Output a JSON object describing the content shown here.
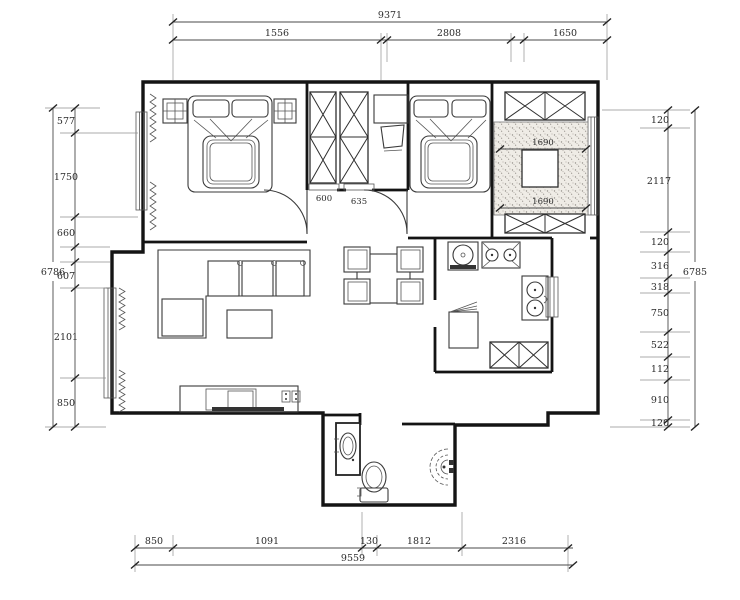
{
  "page": {
    "background": "#ffffff"
  },
  "palette": {
    "wall_line": "#141414",
    "dim_line": "#4a4a4a",
    "dim_text": "#2a2a2a",
    "hatch_bg": "#efece6",
    "hatch_dot": "#95908a"
  },
  "dimensions": {
    "top": {
      "overall": "9371",
      "segments": [
        "1556",
        "2808",
        "1650"
      ]
    },
    "bottom": {
      "overall": "9559",
      "segments": [
        "850",
        "1091",
        "130",
        "1812",
        "2316"
      ]
    },
    "left": {
      "overall": "6786",
      "segments": [
        "577",
        "1750",
        "660",
        "607",
        "2101",
        "850"
      ]
    },
    "right": {
      "overall": "6785",
      "segments": [
        "120",
        "2117",
        "120",
        "316",
        "318",
        "750",
        "522",
        "112",
        "910",
        "120"
      ]
    },
    "interior": {
      "hall_opening_left": "600",
      "hall_opening_right": "635",
      "balcony_width_upper": "1690",
      "balcony_width_lower": "1690"
    }
  }
}
